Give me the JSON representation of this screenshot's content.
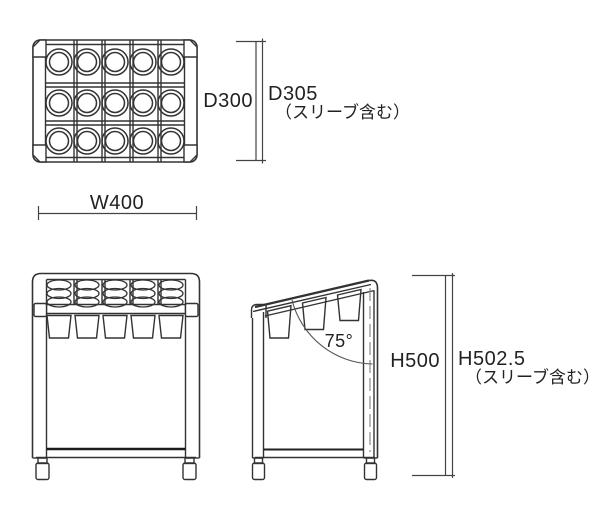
{
  "drawing": {
    "views": {
      "top": {
        "width_dim": "W400",
        "depth_dim": "D300",
        "depth_sleeve_dim": "D305",
        "depth_sleeve_note": "（スリーブ含む）"
      },
      "side": {
        "angle_dim": "75°",
        "height_dim": "H500",
        "height_sleeve_dim": "H502.5",
        "height_sleeve_note": "（スリーブ含む）"
      }
    },
    "colors": {
      "line": "#333333",
      "line_dark": "#1a1a1a",
      "centerline": "#8a8a8a",
      "background": "#ffffff"
    }
  }
}
